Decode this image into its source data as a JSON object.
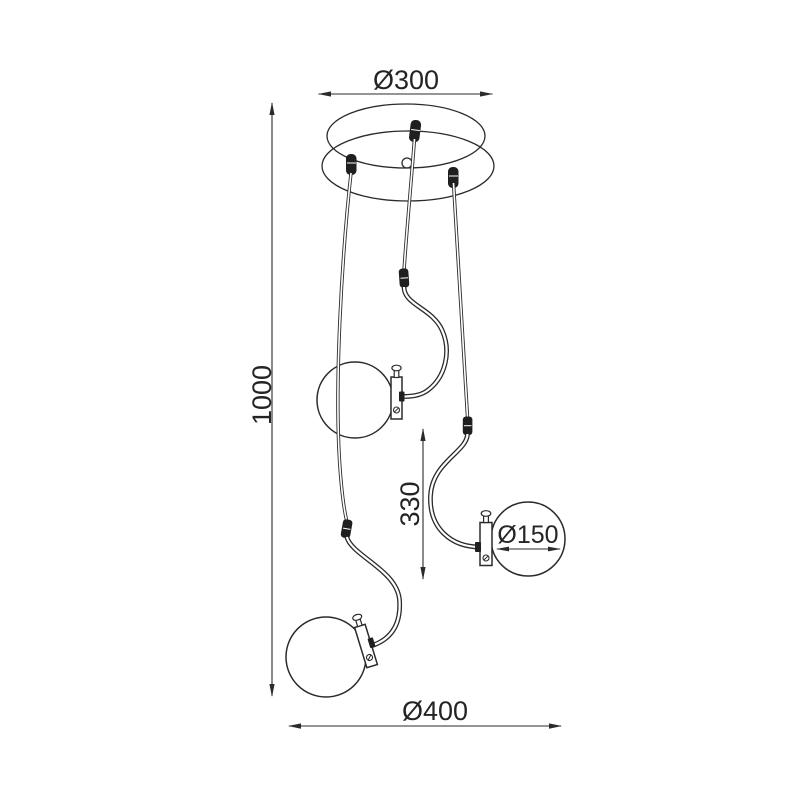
{
  "drawing": {
    "kind": "pendant-lamp-technical-line-drawing",
    "background_color": "#ffffff",
    "line_color": "#2b2b2b",
    "dimensions": {
      "canopy_diameter": "Ø300",
      "overall_height": "1000",
      "arm_section_height": "330",
      "globe_diameter": "Ø150",
      "overall_width": "Ø400"
    }
  }
}
